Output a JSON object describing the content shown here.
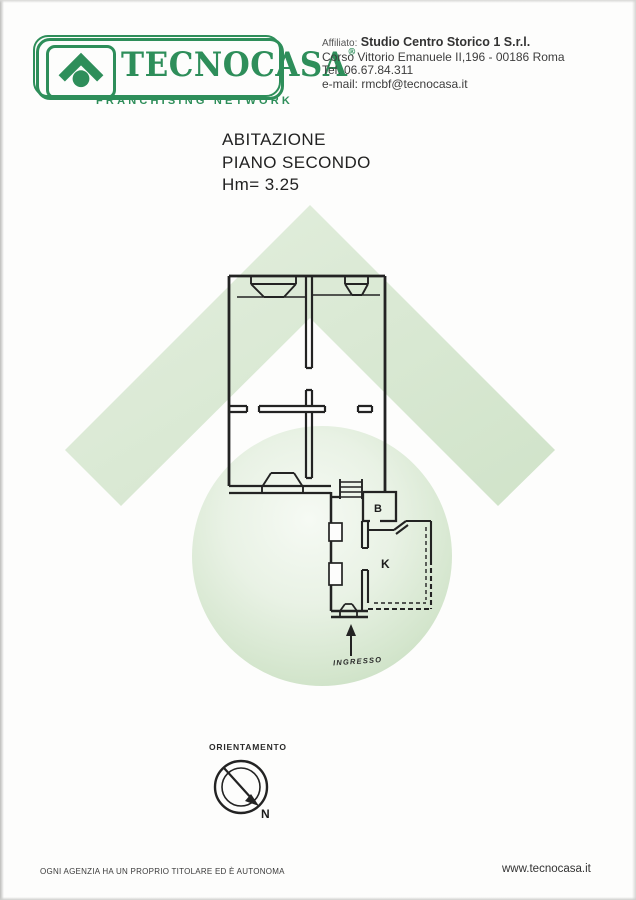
{
  "logo": {
    "brand": "TECNOCASA",
    "registered": "®",
    "tagline": "FRANCHISING NETWORK"
  },
  "affiliate": {
    "label": "Affiliato:",
    "name": "Studio Centro Storico 1 S.r.l.",
    "address": "Corso Vittorio Emanuele II,196 - 00186 Roma",
    "phone": "Tel. 06.67.84.311",
    "email": "e-mail: rmcbf@tecnocasa.it"
  },
  "title": {
    "line1": "ABITAZIONE",
    "line2": "PIANO SECONDO",
    "line3": "Hm= 3.25"
  },
  "plan": {
    "room_b": "B",
    "room_k": "K",
    "entrance_label": "INGRESSO"
  },
  "compass": {
    "label": "ORIENTAMENTO",
    "north": "N"
  },
  "footer": {
    "disclaimer": "OGNI AGENZIA HA UN PROPRIO TITOLARE ED È AUTONOMA",
    "website": "www.tecnocasa.it"
  },
  "colors": {
    "brand_green": "#2e8e5a",
    "watermark_green": "#d9e9d3",
    "line_color": "#232323"
  }
}
